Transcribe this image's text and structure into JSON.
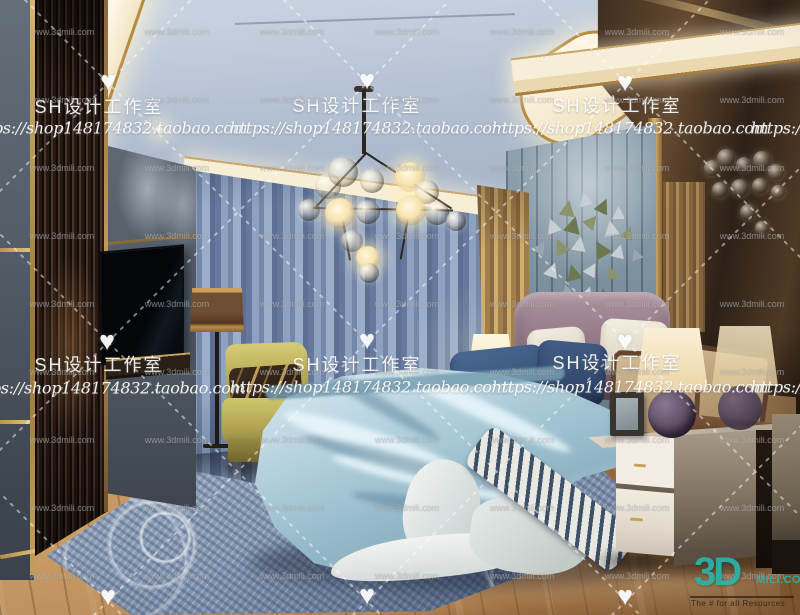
{
  "scene": {
    "description": "3D interior render of a luxury modern bedroom: coved ceiling with gold trim and glass-globe chandelier, blue pleated curtains, channel-tufted headboard wall with 3D triangle wall art, bronze mirror wall, light-blue silk bedding, olive armchair, cream nightstand with lamps, patterned blue rug on warm wood flooring"
  },
  "watermarks": {
    "heart": "♥",
    "studio": "SH设计工作室",
    "url": "https://shop148174832.taobao.com",
    "mili": "www.3dmili.com"
  },
  "logo": {
    "big": "3D",
    "suffix": "MILI.COM",
    "tagline": "The # for all Resources",
    "color": "#2bb3a9"
  },
  "palette": {
    "ceiling": "#b6c2d4",
    "cove_light": "#f7eed6",
    "gold_trim": "#c9a05c",
    "curtains": "#7d90b2",
    "headboard_wall": "#7b8e9c",
    "bedding": "#aecddb",
    "headboard": "#8d7380",
    "armchair": "#b4a751",
    "wood_floor": "#b58350",
    "mirror_bronze": "#4a3626",
    "rug": "#8093ad",
    "watermark": "#ffffff"
  }
}
